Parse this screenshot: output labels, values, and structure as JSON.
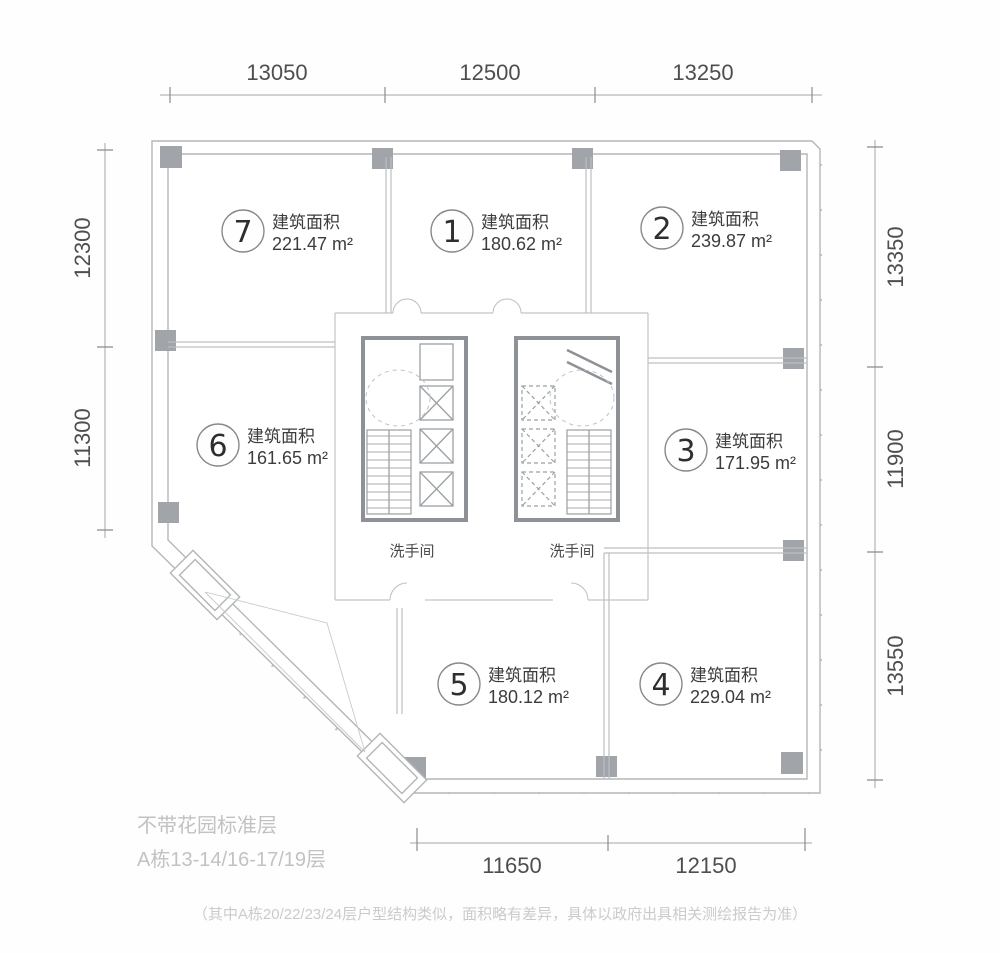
{
  "plan": {
    "units": [
      {
        "num": "7",
        "label": "建筑面积",
        "area": "221.47 m²"
      },
      {
        "num": "1",
        "label": "建筑面积",
        "area": "180.62 m²"
      },
      {
        "num": "2",
        "label": "建筑面积",
        "area": "239.87 m²"
      },
      {
        "num": "6",
        "label": "建筑面积",
        "area": "161.65 m²"
      },
      {
        "num": "3",
        "label": "建筑面积",
        "area": "171.95 m²"
      },
      {
        "num": "5",
        "label": "建筑面积",
        "area": "180.12 m²"
      },
      {
        "num": "4",
        "label": "建筑面积",
        "area": "229.04 m²"
      }
    ],
    "rooms": {
      "restroom_left": "洗手间",
      "restroom_right": "洗手间"
    }
  },
  "dims": {
    "top": [
      "13050",
      "12500",
      "13250"
    ],
    "bottom": [
      "11650",
      "12150"
    ],
    "left": [
      "12300",
      "11300"
    ],
    "right": [
      "13350",
      "11900",
      "13550"
    ]
  },
  "captions": {
    "floor_type": "不带花园标准层",
    "floor_range": "A栋13-14/16-17/19层",
    "note": "（其中A栋20/22/23/24层户型结构类似，面积略有差异，具体以政府出具相关测绘报告为准）"
  },
  "colors": {
    "wall": "#b3b6b8",
    "core_wall": "#8e9296",
    "column": "#a1a5a9",
    "dimension_text": "#4e4e4e",
    "caption_text": "#c2c2c2"
  }
}
